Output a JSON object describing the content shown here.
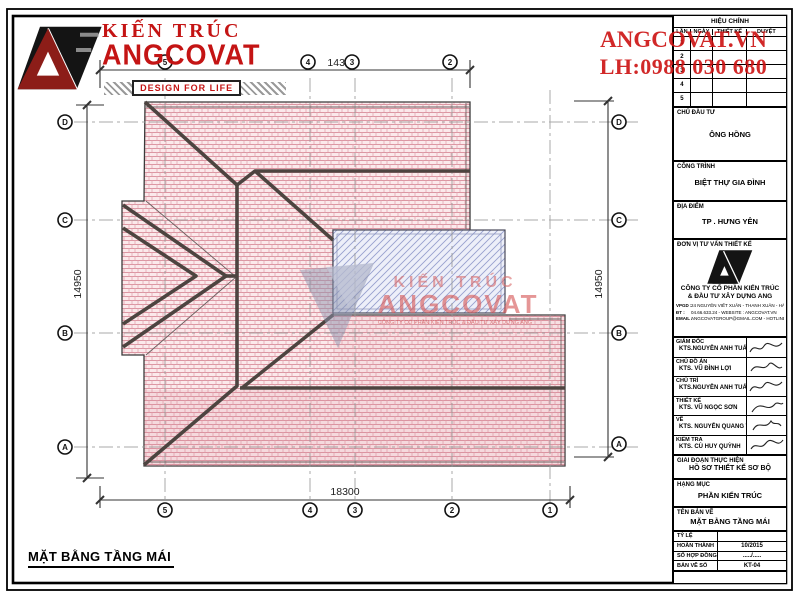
{
  "sheet": {
    "logo": {
      "brand_top": "KIẾN TRÚC",
      "brand_main": "ANGCOVAT",
      "tagline": "DESIGN FOR LIFE"
    },
    "contact": {
      "line1": "ANGCOVAT.VN",
      "line2": "LH:0988 030 680"
    },
    "drawing_label": "MẶT BẰNG TẦNG MÁI"
  },
  "plan": {
    "dimensions": {
      "top": "14300",
      "bottom": "18300",
      "left": "14950",
      "right": "14950"
    },
    "grid": {
      "columns": [
        "5",
        "4",
        "3",
        "2",
        "1"
      ],
      "rows": [
        "D",
        "C",
        "B",
        "A"
      ]
    },
    "watermark": {
      "line1": "KIẾN TRÚC",
      "line2": "ANGCOVAT",
      "line3": "CÔNG TY CỔ PHẦN KIẾN TRÚC & ĐẦU TƯ XÂY DỰNG ANG"
    },
    "colors": {
      "roof_hatch": "#dc96a2",
      "roof_bg": "#fbe9eb",
      "terrace_hatch": "#97a0cf",
      "terrace_bg": "#edeff9",
      "ridge": "#4d4440",
      "accent_red": "#c41414"
    }
  },
  "titleblock": {
    "revision": {
      "title": "HIỆU CHỈNH",
      "columns": [
        "LẦN",
        "NGÀY",
        "THIẾT KẾ",
        "DUYỆT"
      ],
      "rows": [
        "1",
        "2",
        "3",
        "4",
        "5"
      ]
    },
    "chu_dau_tu": {
      "label": "CHỦ ĐẦU TƯ",
      "value": "ÔNG HỒNG"
    },
    "cong_trinh": {
      "label": "CÔNG TRÌNH",
      "value": "BIỆT THỰ GIA ĐÌNH"
    },
    "dia_diem": {
      "label": "ĐỊA ĐIỂM",
      "value": "TP . HƯNG YÊN"
    },
    "don_vi": {
      "label": "ĐƠN VỊ TƯ VẤN THIẾT KẾ",
      "company_line1": "CÔNG TY CỔ PHẦN KIẾN TRÚC",
      "company_line2": "& ĐẦU TƯ XÂY DỰNG ANG",
      "address": [
        {
          "label": "VPGD :",
          "value": "24 NGUYỄN VIẾT XUÂN - THANH XUÂN - HÀ NỘI"
        },
        {
          "label": "ĐT :",
          "value": "04.66.633.24 - WEBSITE : ANGCOVAT.VN"
        },
        {
          "label": "EMAIL :",
          "value": "ANGCOVATGROUP@GMAIL.COM - HOTLINE : 0988.030.680"
        }
      ]
    },
    "personnel": [
      {
        "role": "GIÁM ĐỐC",
        "name": "KTS.NGUYỄN ANH TUẤN"
      },
      {
        "role": "CHỦ ĐỒ ÁN",
        "name": "KTS. VŨ ĐÌNH LỢI"
      },
      {
        "role": "CHỦ TRÌ",
        "name": "KTS.NGUYỄN ANH TUẤN"
      },
      {
        "role": "THIẾT KẾ",
        "name": "KTS. VŨ NGỌC SƠN"
      },
      {
        "role": "VẼ",
        "name": "KTS. NGUYỄN QUANG THÁI"
      },
      {
        "role": "KIỂM TRA",
        "name": "KTS. CÙ HUY QUỲNH"
      }
    ],
    "giai_doan": {
      "label": "GIAI ĐOẠN THỰC HIỆN",
      "value": "HỒ SƠ THIẾT KẾ SƠ BỘ"
    },
    "hang_muc": {
      "label": "HẠNG MỤC",
      "value": "PHẦN KIẾN TRÚC"
    },
    "ten_ban_ve": {
      "label": "TÊN BẢN VẼ",
      "value": "MẶT BẰNG TẦNG MÁI"
    },
    "info_rows": [
      {
        "label": "TỶ LỆ",
        "value": ""
      },
      {
        "label": "HOÀN THÀNH",
        "value": "10/2015"
      },
      {
        "label": "SỐ HỢP ĐỒNG",
        "value": "...../....."
      },
      {
        "label": "BẢN VẼ SỐ",
        "value": "KT-04"
      }
    ]
  }
}
